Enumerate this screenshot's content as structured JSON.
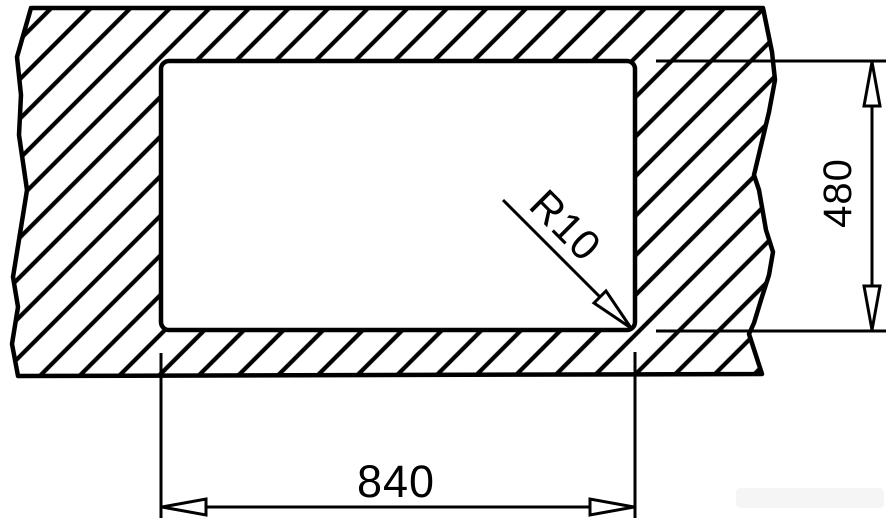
{
  "drawing": {
    "kind": "installation-cutout-dimension-diagram",
    "labels": {
      "width": "840",
      "height": "480",
      "corner_radius": "R10"
    },
    "colors": {
      "line": "#000000",
      "background": "#ffffff",
      "cutout_fill": "#ffffff"
    }
  }
}
